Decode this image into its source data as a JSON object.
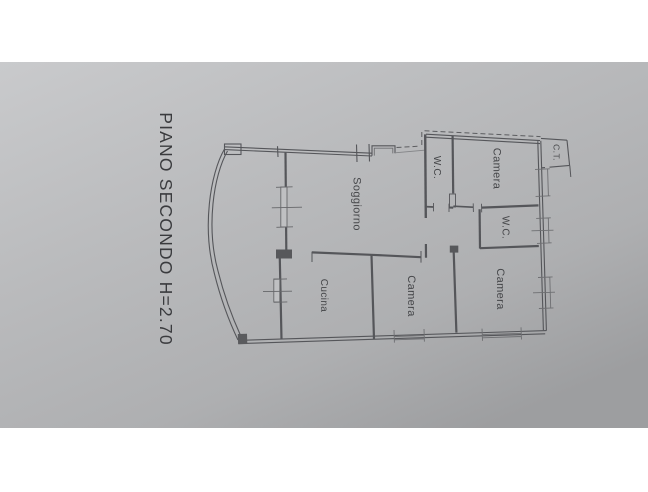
{
  "photo": {
    "description": "photograph of an architectural floor plan sheet, drawing rotated 90 degrees clockwise",
    "title": "PIANO SECONDO H=2.70",
    "rooms": [
      {
        "id": "soggiorno",
        "label": "Soggiorno"
      },
      {
        "id": "cucina",
        "label": "Cucina"
      },
      {
        "id": "camera-bottom-middle",
        "label": "Camera"
      },
      {
        "id": "camera-bottom-right",
        "label": "Camera"
      },
      {
        "id": "camera-top-right",
        "label": "Camera"
      },
      {
        "id": "wc-top",
        "label": "W.C."
      },
      {
        "id": "wc-middle",
        "label": "W.C."
      },
      {
        "id": "ct",
        "label": "C.T."
      }
    ]
  },
  "colors": {
    "letterbox_band": "#ffffff",
    "paper_light": "#c7c8ca",
    "paper_mid": "#b7b8ba",
    "paper_dark": "#9fa0a2",
    "wall_ink": "#55565a",
    "light_ink": "#6e6f72",
    "label_ink": "#46474a"
  }
}
